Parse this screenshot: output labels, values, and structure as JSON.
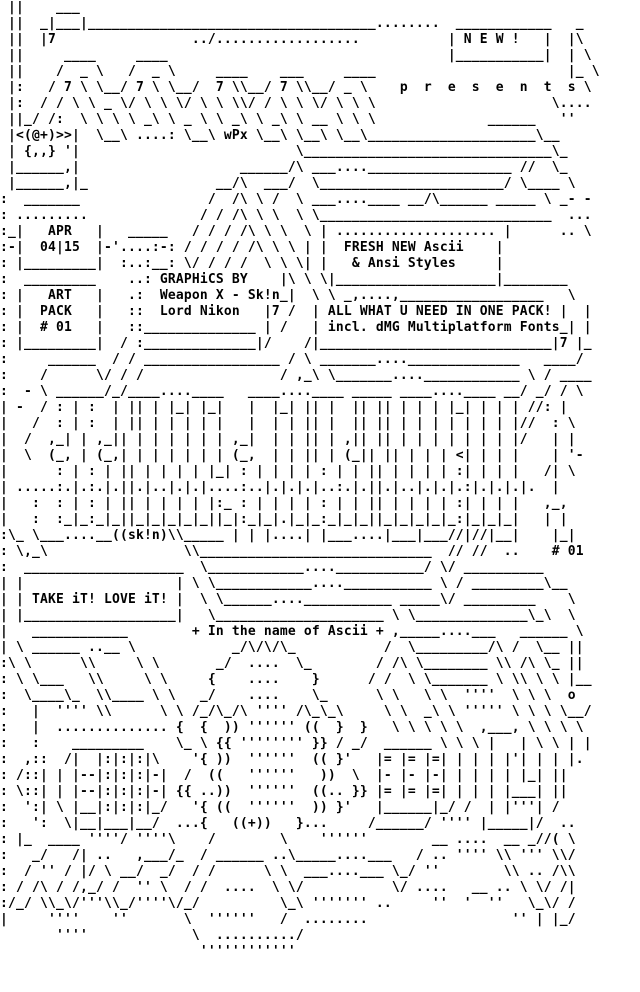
{
  "page": {
    "kind": "ascii-art-pack-promo",
    "ink_color": "#000000",
    "paper_color": "#ffffff",
    "grid": {
      "columns": 80,
      "rows": 62,
      "cell_w": 8,
      "cell_h": 16
    }
  },
  "texts": {
    "new_badge": "N E W !",
    "presents": "p r e s e n t s",
    "group_tag": "wPx",
    "mascot": "<(@+)>>  {,,}",
    "date_box": "APR 04|15",
    "pack_box": "ART PACK # 01",
    "credits_box": "GRAPHiCS BY Weapon X - Sk!n Lord Nikon",
    "fresh_box": "FRESH NEW Ascii & Ansi Styles",
    "all_in_one_box": "ALL WHAT U NEED IN ONE PACK! incl. dMG Multiplatform Fonts",
    "artist_sig": "((sk!n)",
    "pack_number": "# 01",
    "take_it_box": "TAKE iT! LOVE iT!",
    "tagline": "+ In the name of Ascii +",
    "machine_mark": "((+))"
  },
  "ascii_art": {
    "lines": [
      " ||    ___                                                                 ",
      " ||  _|___|____________________________________........  ____________   _ ",
      " ||  |7                 ../..................           | N E W !   |  |\\ ",
      " ||     ____     ____                                   |___________|  | \\",
      " ||    /  _ \\   /  _ \\     ____    ___     ____                        |_ \\",
      " |:   / 7 \\ \\__/ 7 \\ \\__/  7 \\\\__/ 7 \\\\__/ _ \\    p  r  e  s  e  n  t  s \\",
      " |:  / / \\ \\ _ \\/ \\ \\ \\/ \\ \\ \\\\/ / \\ \\ \\/ \\ \\ \\                      \\....",
      " ||_/ /:  \\ \\ \\ \\ _\\ \\ _ \\ \\ _\\ \\ _\\ \\ __ \\ \\ \\              ______   '' ",
      " |<(@+)>>|  \\__\\ ....: \\__\\ wPx \\__\\ \\__\\ \\__\\_____________________\\__   ",
      " | {,,} '|                           \\_______________________________\\_  ",
      " |______,|                    ______/\\ ___....__________________ //  \\_  ",
      " |______,|_                __/\\  ___/  \\_______________________/ \\____ \\ ",
      ":  _______                /  /\\ \\ /  \\ ___....____ __/\\______ _____ \\ _- -",
      ": .........              / / /\\ \\ \\  \\ \\_____________________________  ...",
      ":_|   APR   |   _____   / / / /\\ \\ \\  \\ | .................... |      .. \\",
      ":-|  04|15  |-'....:-: / / / / /\\ \\ \\ | |  FRESH NEW Ascii    |           ",
      ": |_________|  :..:__: \\/ / / /  \\ \\ \\| |   & Ansi Styles     |           ",
      ":  _________    ..: GRAPHiCS BY    |\\ \\ \\|____________________|________   ",
      ": |   ART   |   .:  Weapon X - Sk!n_|  \\ \\ _,....,__________________   \\  ",
      ": |  PACK   |   ::  Lord Nikon   |7 /  | ALL WHAT U NEED IN ONE PACK! |  |",
      ": |  # 01   |   ::______________ | /   | incl. dMG Multiplatform Fonts_| |",
      ": |_________|  / :______________|/    /|_____________________________|7 |_",
      ":     ______  / / _________________ / \\ _______....______________   ____/ ",
      ":    /      \\/ / /                 / ,_\\ \\_______....____________ \\ / ____",
      ":  - \\ ______/_/____....____   ____....____ _____ ____....____ __/ _/ / \\ ",
      "| -  / : | :  | || | |_| |_|   |  |_| || |  || || | | | |_| | | | //: |   ",
      "|   /  : | :  | || | | | | |   |  | | || |  || || | | | | | | | |//  : \\  ",
      "|  /  ,_| | ,_|| | | | | | | ,_|  | | || | ,|| || | | | | | | | |/   | |  ",
      "|  \\  (_, | (_,| | | | | | | (_,  | | || | (_|| || | | | <| | | |    | '- ",
      "|      : | : | || | | | | |_| : | | | | : | | || | | | | :| | | |   /| \\  ",
      "| .....:.|.:.|.||.|..|.|.|....:..|.|.|.|..:.|.||.|..|.|.|.:|.|.|.|.  |    ",
      "|   :  : | : | || | | | | |:_ : | | | | : | | || | | | | :| | | |   ,_,   ",
      "|   :  :_|_:_|_||_|_|_|_|_||_|:_|_|.|_|_:_|_|_||_|_|_|_|_:|_|_|_|   | |   ",
      ":\\_ \\___....__((sk!n)\\\\_____ | | |....| |___....|___|___//|//|__|    |_|   ",
      ": \\,_\\                 \\\\_____________________________  // //  ..    # 01 ",
      ":  ____________________  \\____________....___________/ \\/ __________      ",
      "| |                   | \\ \\____________....___________ \\ / _________\\__   ",
      "| | TAKE iT! LOVE iT! |  \\ \\______....___________ _____\\/ _________    \\  ",
      "| |___________________|   \\_____________________ \\ \\______________\\_\\  \\  ",
      "|   ____________        + In the name of Ascii + ,_____....___   ______ \\ ",
      "| \\ ______ ..__ \\            _/\\/\\/\\_           /  \\_________/\\ /  \\__ || ",
      ":\\ \\      \\\\     \\ \\       _/  ....  \\_        / /\\ \\________ \\\\ /\\ \\_ || ",
      ": \\ \\___   \\\\     \\ \\     {    ....    }      / /  \\ \\_______ \\ \\\\ \\ \\ |__",
      ":  \\____\\_  \\\\____ \\ \\   _/    ....    \\_      \\ \\   \\ \\  ''''  \\ \\ \\  o  ",
      ":   |  '''' \\\\      \\ \\ /_/\\_/\\ '''' /\\_\\_\\     \\ \\  _\\ \\ ''''' \\ \\ \\ \\__/",
      ":   |  .............. {  {  )) '''''' ((  }  }   \\ \\ \\ \\ \\  ,___, \\ \\ \\ \\ ",
      ":   :    _________    \\_ \\ {{ '''''''' }} / _/  ______ \\ \\ \\ |   | \\ \\ | |",
      ":  ,::  /|  |:|:|:|\\    '{ ))  ''''''  (( }'   |= |= |=| | | | |'| | | |. ",
      ": /::| | |--|:|:|:|-|  /  ((   ''''''   ))  \\  |- |- |-| | | | | |_| ||   ",
      ": \\::| | |--|:|:|:|-| {{ ..))  ''''''  ((.. }} |= |= |=| | | | |___| ||   ",
      ":  ':| \\ |__|:|:|:|_/   '{ ((  ''''''  )) }'   |______|_/ /  | |'''| /    ",
      ":   ':  \\|__|___|__/  ...{   ((+))   }...     /______/ '''' |_____|/  ..  ",
      ": |_  ____ ''''/ ''''\\    /        \\    ''''''        __ ....  __ _//( \\  ",
      ":   _/   /| ..   ,___/_  / ______ ..\\_____....___   / .. '''' \\\\ ''' \\\\/ ",
      ":  / '' / |/ \\ __/  _/  / /      \\ \\  ___....___ \\_/ ''        \\\\ .. /\\\\ ",
      ": / /\\ / /,_/ /  '' \\  / /  ....  \\ \\/           \\/ ....   __ .. \\ \\/ /| ",
      ":/_/ \\\\_\\/'''\\\\_/''''\\/_/          \\_\\ ''''''' ..     ''  '  ''   \\_\\/ / ",
      "|     ''''    ''       \\  ''''''   /  ........                  '' | |_/ ",
      "       ''''             \\  ........../                                    ",
      "                         ''''''''''''                                     ",
      "                                                                          ",
      "                                                                          "
    ]
  }
}
